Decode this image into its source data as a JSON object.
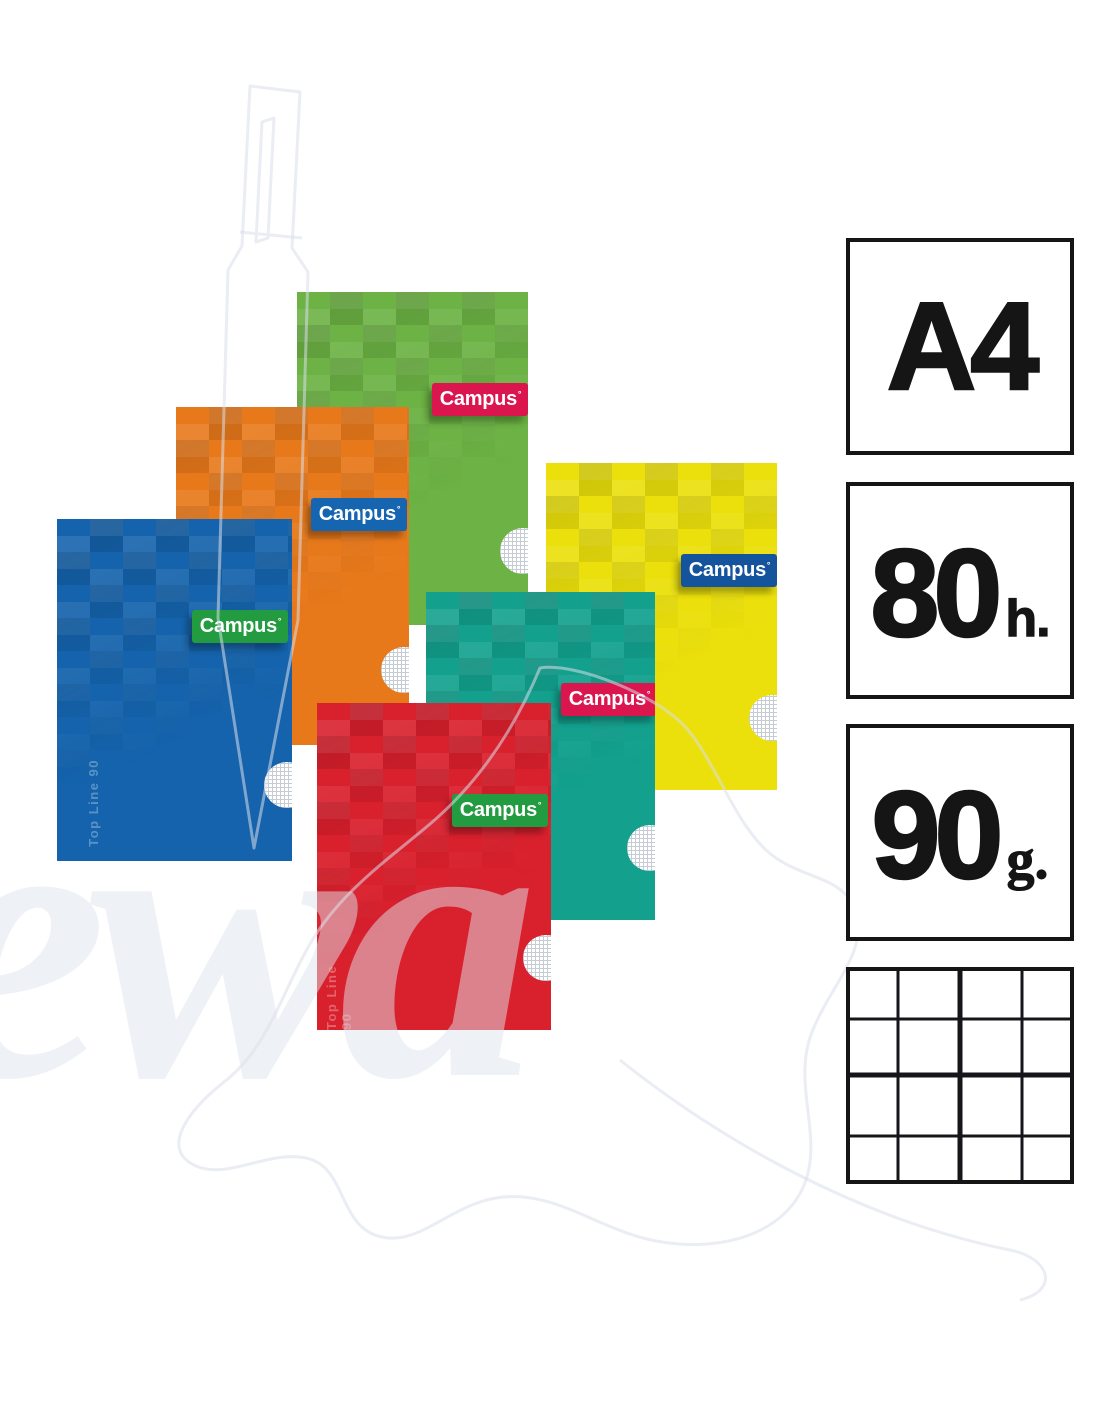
{
  "product": {
    "brand": "Campus"
  },
  "notebooks": [
    {
      "name": "green",
      "cover_color": "#6CB244",
      "label": {
        "text": "Campus",
        "mark": "°",
        "bg_color": "#DB164F"
      }
    },
    {
      "name": "orange",
      "cover_color": "#E8791B",
      "label": {
        "text": "Campus",
        "mark": "°",
        "bg_color": "#1565B0"
      }
    },
    {
      "name": "blue",
      "cover_color": "#1563AC",
      "label": {
        "text": "Campus",
        "mark": "°",
        "bg_color": "#239B41"
      },
      "side_text": "Top Line 90"
    },
    {
      "name": "yellow",
      "cover_color": "#EBE00C",
      "label": {
        "text": "Campus",
        "mark": "°",
        "bg_color": "#14549C"
      }
    },
    {
      "name": "teal",
      "cover_color": "#13A18E",
      "label": {
        "text": "Campus",
        "mark": "°",
        "bg_color": "#DB164F"
      }
    },
    {
      "name": "red",
      "cover_color": "#D9202D",
      "label": {
        "text": "Campus",
        "mark": "°",
        "bg_color": "#239B41"
      },
      "side_text": "Top Line 90"
    }
  ],
  "specs": {
    "border_color": "#151515",
    "text_color": "#151515",
    "items": [
      {
        "id": "paper-size",
        "value": "A4",
        "unit": ""
      },
      {
        "id": "sheet-count",
        "value": "80",
        "unit": "h."
      },
      {
        "id": "paper-weight",
        "value": "90",
        "unit": "g."
      },
      {
        "id": "ruling",
        "icon": "grid-paper-icon"
      }
    ]
  },
  "watermark": {
    "text": "ewa"
  }
}
